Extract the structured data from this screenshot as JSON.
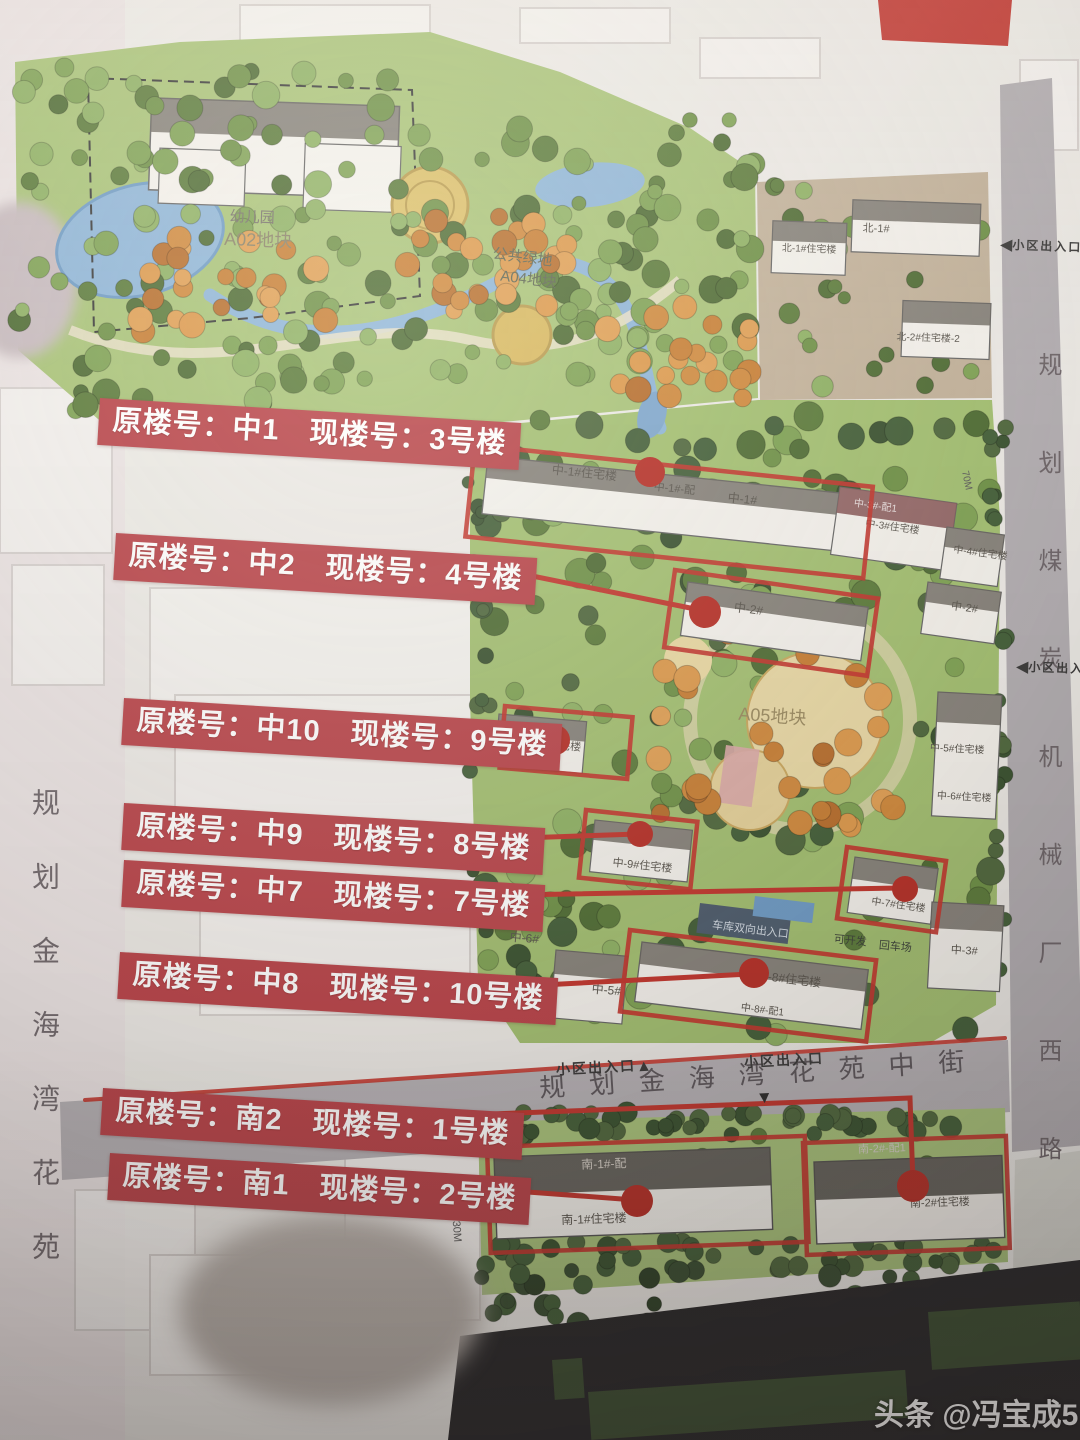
{
  "photo": {
    "watermark_brand": "头条",
    "watermark_handle": "@冯宝成5"
  },
  "colors": {
    "label_background": "#b9444a",
    "highlight_red": "#c2372f",
    "park_green": "#a9c479",
    "road_grey": "#b7b3b7",
    "water_blue": "#8fb6d9"
  },
  "streets": {
    "left_vertical": "规划金海湾花苑",
    "right_vertical": "规划煤炭机械厂西路",
    "bottom": "规划金海湾花苑中街",
    "entrance_label": "小区出入口"
  },
  "mapping_labels": [
    {
      "old": "中1",
      "new": "3号楼",
      "full": "原楼号：中1　现楼号：3号楼"
    },
    {
      "old": "中2",
      "new": "4号楼",
      "full": "原楼号：中2　现楼号：4号楼"
    },
    {
      "old": "中10",
      "new": "9号楼",
      "full": "原楼号：中10　现楼号：9号楼"
    },
    {
      "old": "中9",
      "new": "8号楼",
      "full": "原楼号：中9　现楼号：8号楼"
    },
    {
      "old": "中7",
      "new": "7号楼",
      "full": "原楼号：中7　现楼号：7号楼"
    },
    {
      "old": "中8",
      "new": "10号楼",
      "full": "原楼号：中8　现楼号：10号楼"
    },
    {
      "old": "南2",
      "new": "1号楼",
      "full": "原楼号：南2　现楼号：1号楼"
    },
    {
      "old": "南1",
      "new": "2号楼",
      "full": "原楼号：南1　现楼号：2号楼"
    }
  ],
  "parcels": {
    "kindergarten": "幼儿园",
    "kindergarten_block": "A02地块",
    "public_green": "公共绿地",
    "public_green_block": "A04地块",
    "main_block": "A05地块"
  },
  "buildings": {
    "n1a": "北-1#住宅楼",
    "n1b": "北-1#",
    "n2": "北-2#住宅楼-2",
    "z1a": "中-1#住宅楼",
    "z1b": "中-1#-配",
    "z1c": "中-1#",
    "z3p": "中-3#-配1",
    "z3a": "中-3#住宅楼",
    "z4": "中-4#住宅楼",
    "z2": "中-2#",
    "z2r": "中-2#",
    "z10": "中-10#住宅楼",
    "z9": "中-9#住宅楼",
    "z7": "中-7#住宅楼",
    "z8": "中-8#住宅楼",
    "z8p": "中-8#-配1",
    "z5": "中-5#",
    "z6": "中-6#",
    "z5r": "中-5#住宅楼",
    "z6r": "中-6#住宅楼",
    "z3r": "中-3#",
    "s1p": "南-1#-配",
    "s1": "南-1#住宅楼",
    "s2p": "南-2#-配1",
    "s2": "南-2#住宅楼"
  },
  "features": {
    "garage_entrance": "车库双向出入口",
    "developable": "可开发",
    "turnaround": "回车场"
  },
  "dimensions": {
    "d1": "15.30M",
    "d2": "70M"
  }
}
